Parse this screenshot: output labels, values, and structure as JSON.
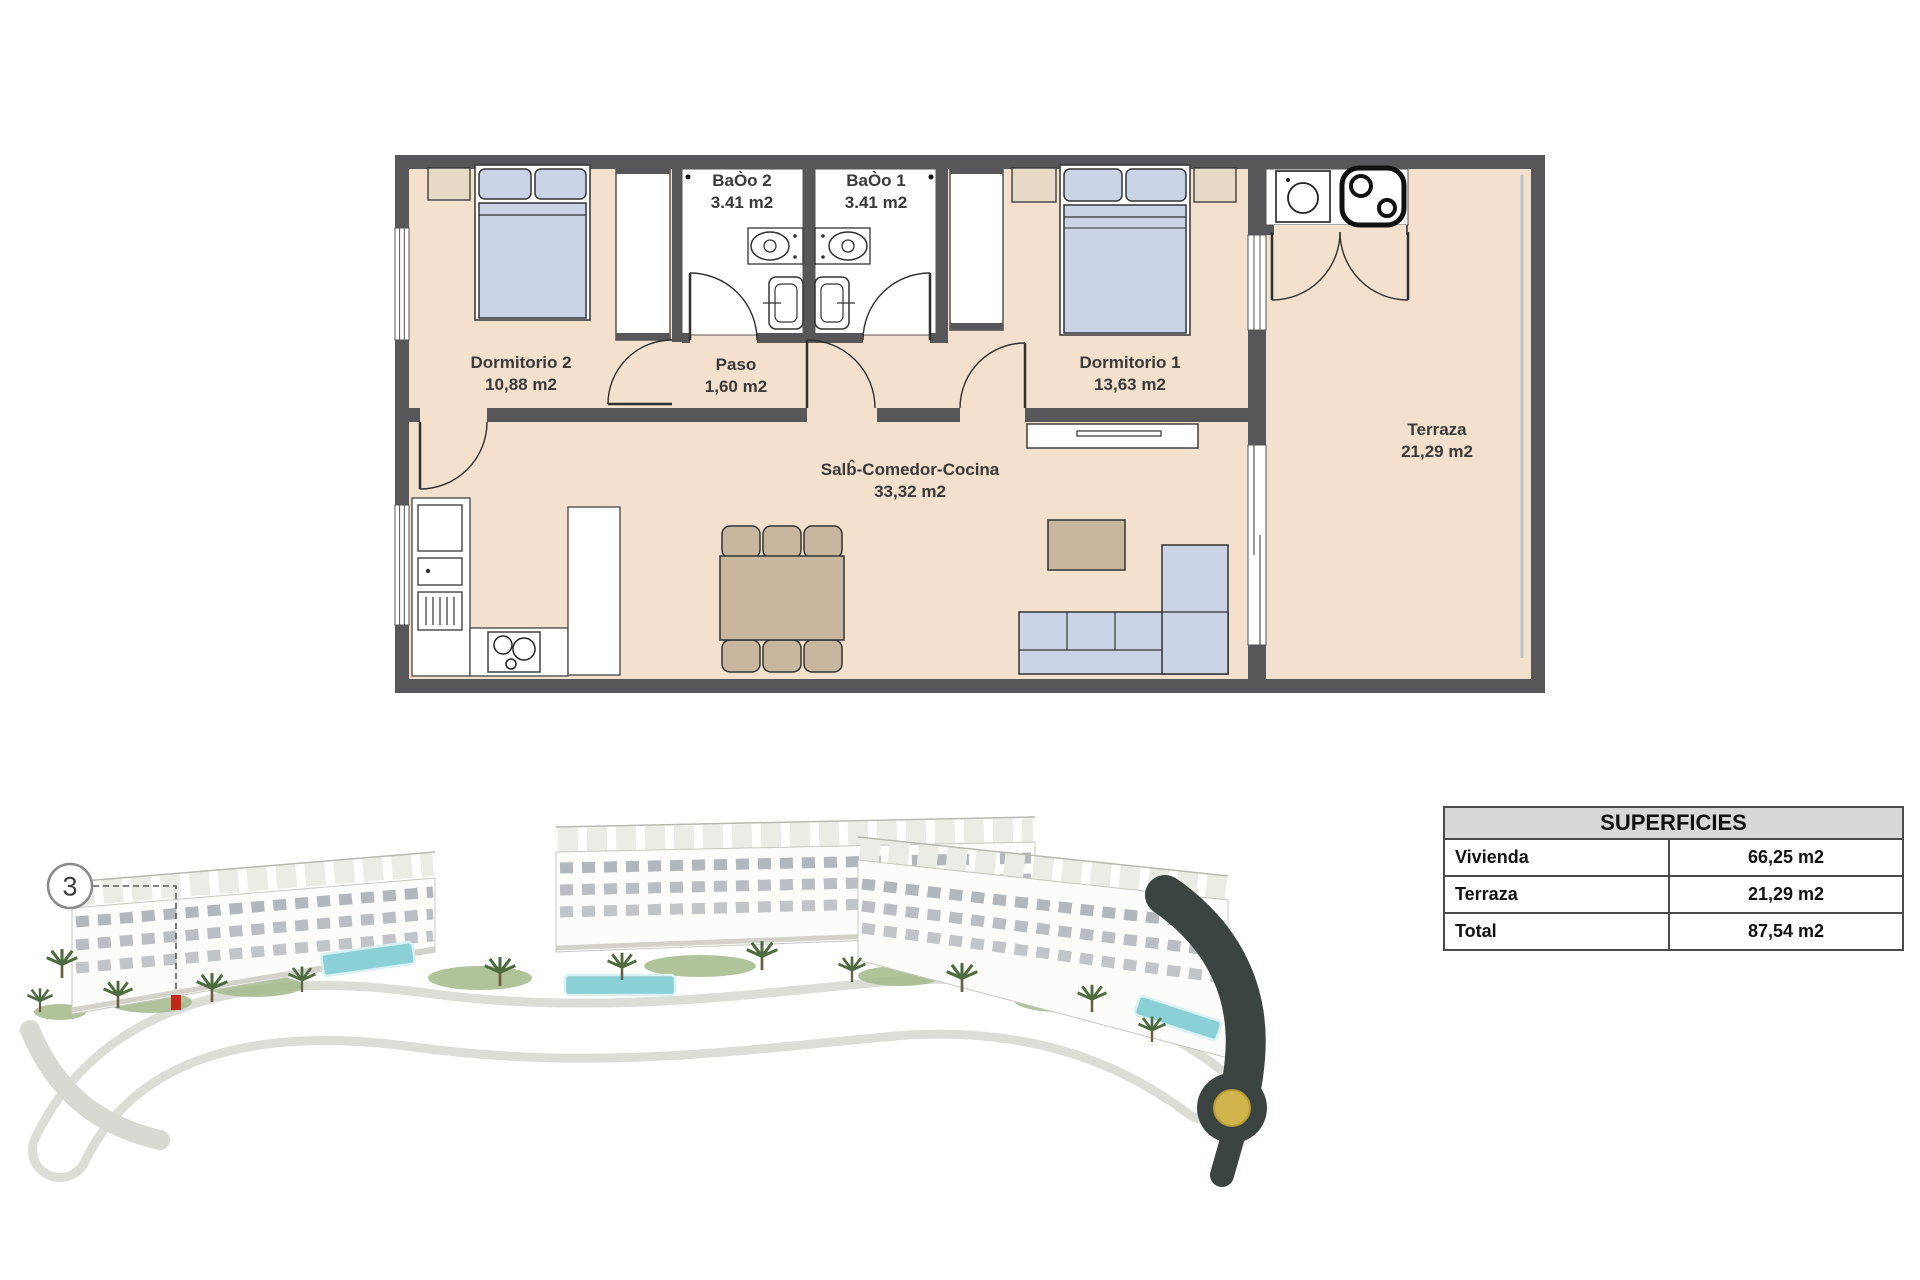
{
  "floor_plan": {
    "rooms": [
      {
        "id": "dormitorio2",
        "name": "Dormitorio 2",
        "area": "10,88 m2"
      },
      {
        "id": "bano2",
        "name": "BaÒo 2",
        "area": "3.41 m2"
      },
      {
        "id": "bano1",
        "name": "BaÒo 1",
        "area": "3.41 m2"
      },
      {
        "id": "paso",
        "name": "Paso",
        "area": "1,60 m2"
      },
      {
        "id": "dormitorio1",
        "name": "Dormitorio 1",
        "area": "13,63 m2"
      },
      {
        "id": "salon",
        "name": "Salb̂-Comedor-Cocina",
        "area": "33,32 m2"
      },
      {
        "id": "terraza",
        "name": "Terraza",
        "area": "21,29 m2"
      }
    ],
    "colors": {
      "floor": "#f3e1cd",
      "wall": "#57575a",
      "furniture_blue": "#cbd3e6",
      "furniture_tan": "#c8b79e"
    }
  },
  "superficies": {
    "title": "SUPERFICIES",
    "rows": [
      {
        "label": "Vivienda",
        "value": "66,25 m2"
      },
      {
        "label": "Terraza",
        "value": "21,29 m2"
      },
      {
        "label": "Total",
        "value": "87,54 m2"
      }
    ]
  },
  "site_render": {
    "unit_marker": "3",
    "marker_color": "#c2281c",
    "pool_color": "#8bd0d6",
    "roundabout_center_color": "#d2b44c"
  }
}
